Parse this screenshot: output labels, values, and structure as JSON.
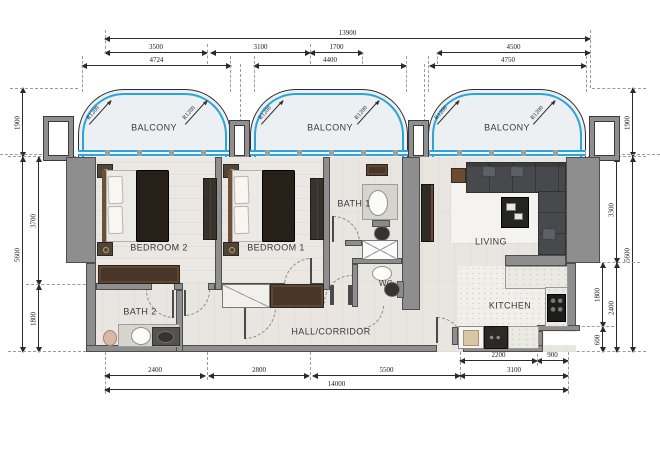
{
  "annotations": {
    "radius": "R1200"
  },
  "rooms": {
    "balcony": "BALCONY",
    "bedroom1": "BEDROOM 1",
    "bedroom2": "BEDROOM 2",
    "bath1": "BATH 1",
    "bath2": "BATH 2",
    "wc": "WC",
    "living": "LIVING",
    "kitchen": "KITCHEN",
    "hall": "HALL/CORRIDOR"
  },
  "dims": {
    "top_total": "13900",
    "top_a": "3500",
    "top_b": "3100",
    "top_c": "1700",
    "top_d": "4500",
    "bal_a": "4724",
    "bal_b": "4400",
    "bal_c": "4750",
    "bot_k1": "2200",
    "bot_k2": "900",
    "bot_a": "2400",
    "bot_b": "2800",
    "bot_c": "5500",
    "bot_d": "3100",
    "bot_total": "14000",
    "left_top": "1900",
    "left_total": "5600",
    "left_a": "3700",
    "left_b": "1800",
    "right_top": "1900",
    "right_total": "5600",
    "right_a": "3300",
    "right_b": "2400",
    "right_c": "1800",
    "right_d": "600"
  },
  "colors": {
    "railing_blue": "#2aa4d9",
    "wall_gray": "#8e8e8e",
    "floor_wood": "#e9e6e1",
    "balcony_floor": "#edf0f3",
    "furniture_dark": "#262019",
    "sofa_gray": "#47494c"
  }
}
